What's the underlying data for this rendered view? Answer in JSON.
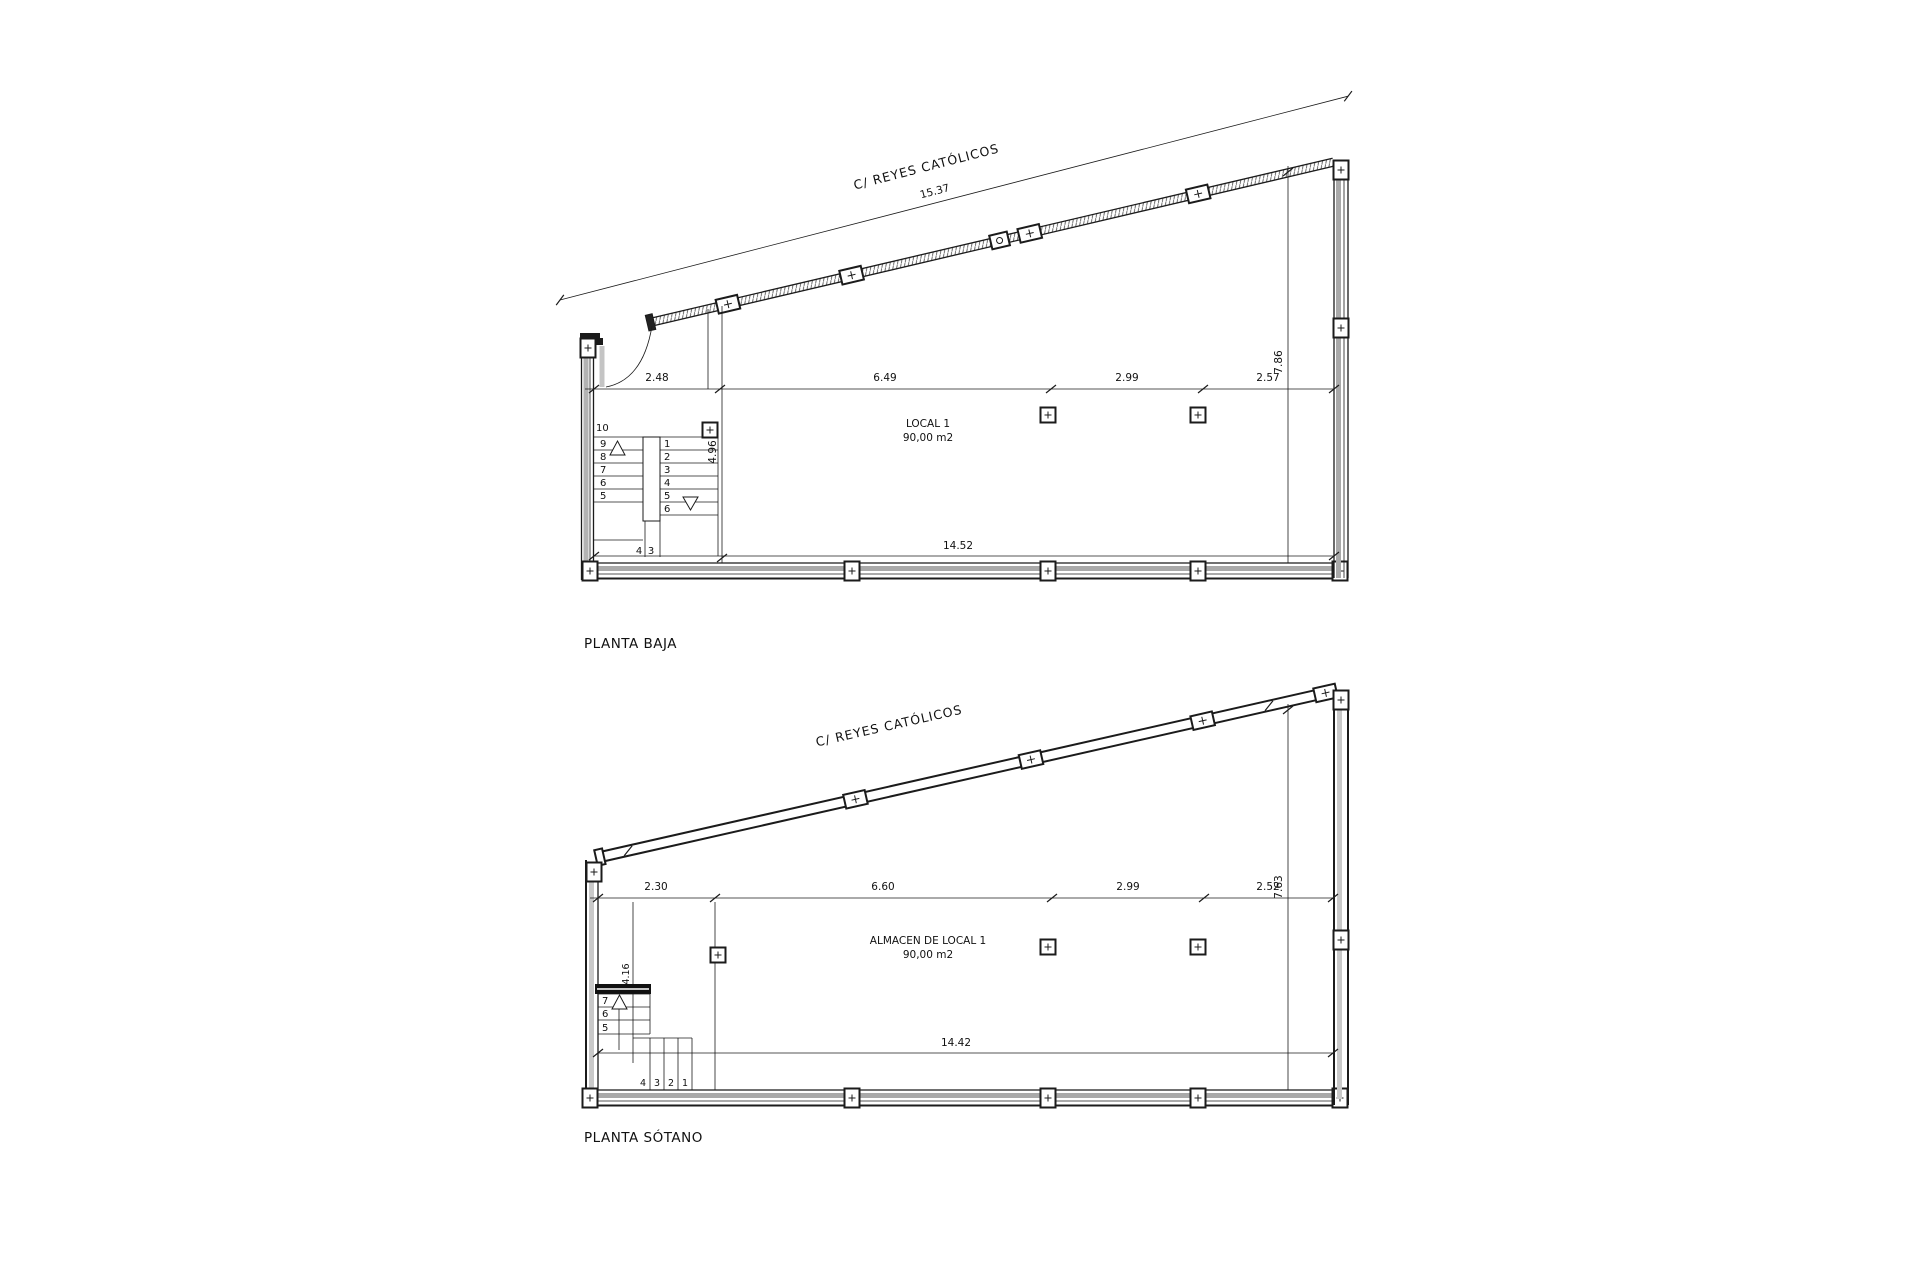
{
  "drawing": {
    "background": "#ffffff",
    "line_color": "#1b1b1b",
    "wall_fill_gray": "#b0b0b0"
  },
  "plans": [
    {
      "title": "PLANTA BAJA",
      "street_label": "C/ REYES CATÓLICOS",
      "room": {
        "name": "LOCAL 1",
        "area": "90,00 m2"
      },
      "dims": {
        "street_total": "15.37",
        "segments": [
          "2.48",
          "6.49",
          "2.99",
          "2.57"
        ],
        "right_depth": "7.86",
        "interior_depth": "4.96",
        "bottom_total": "14.52"
      },
      "stair": {
        "left": [
          "10",
          "9",
          "8",
          "7",
          "6",
          "5"
        ],
        "right": [
          "1",
          "2",
          "3",
          "4",
          "5",
          "6"
        ],
        "bottom": [
          "4",
          "3"
        ]
      }
    },
    {
      "title": "PLANTA SÓTANO",
      "street_label": "C/ REYES CATÓLICOS",
      "room": {
        "name": "ALMACEN DE LOCAL 1",
        "area": "90,00 m2"
      },
      "dims": {
        "segments": [
          "2.30",
          "6.60",
          "2.99",
          "2.52"
        ],
        "right_depth": "7.63",
        "stair_length": "4.16",
        "bottom_total": "14.42"
      },
      "stair": {
        "left": [
          "7",
          "6",
          "5"
        ],
        "bottom": [
          "4",
          "3",
          "2",
          "1"
        ]
      }
    }
  ]
}
